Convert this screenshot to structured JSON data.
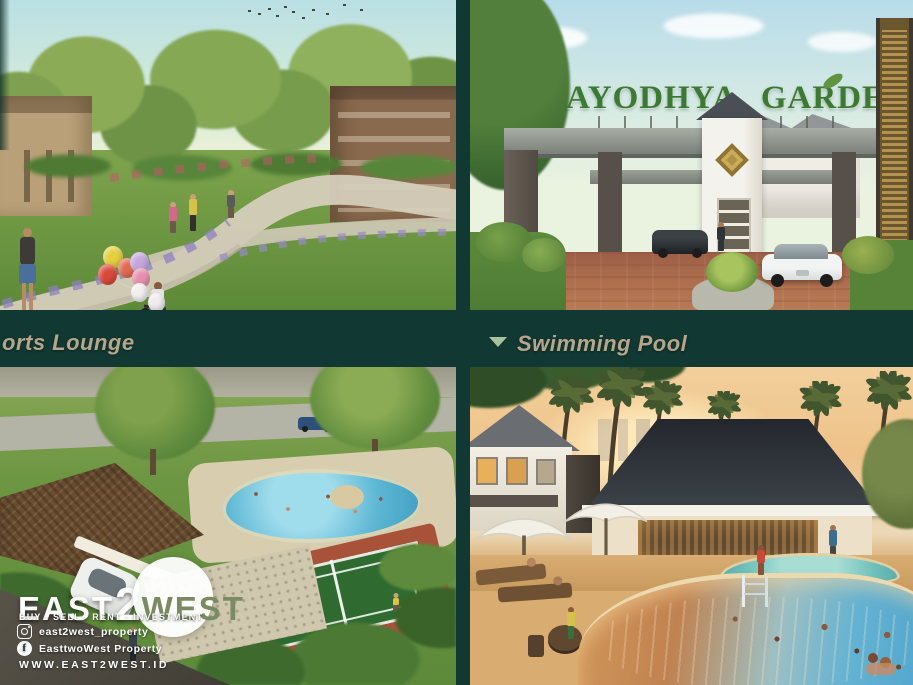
{
  "theme": {
    "background_teal": "#113832",
    "label_tan": "#b7a68c",
    "marker_green": "#a9c29e",
    "sign_green": "#3c7a33",
    "logo_white": "#ffffff"
  },
  "gate_sign": {
    "text": "AYODHYA GARDEN"
  },
  "section_labels": {
    "sports_lounge": "orts Lounge",
    "swimming_pool": "Swimming Pool"
  },
  "brand": {
    "logo_east": "EAST",
    "logo_two": "2",
    "logo_west": "WEST",
    "tagline": "BUY · SELL · RENT · INVESTMENT",
    "instagram_handle": "east2west_property",
    "facebook_name": "EasttwoWest Property",
    "website": "WWW.EAST2WEST.ID"
  },
  "icons": {
    "section_marker": "triangle-down-icon",
    "instagram": "instagram-icon",
    "facebook": "facebook-icon"
  }
}
